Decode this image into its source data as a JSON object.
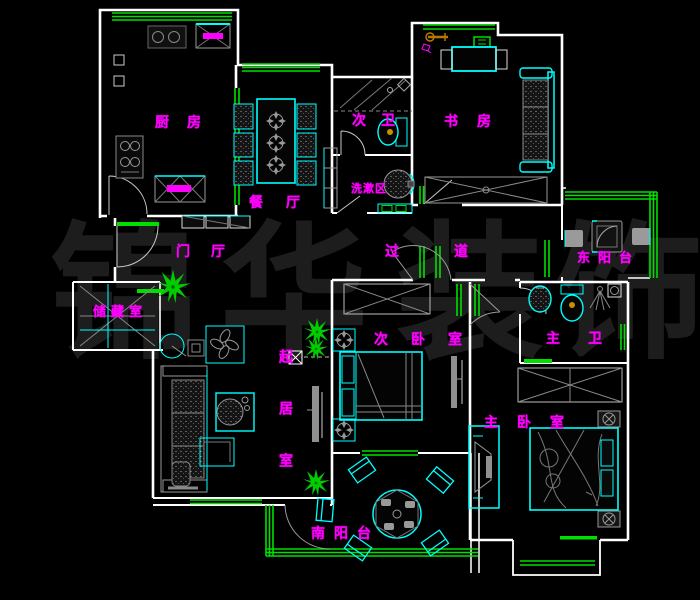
{
  "floor_plan": {
    "watermark": {
      "text": "锦华装饰",
      "chars": [
        "锦",
        "华",
        "装",
        "饰"
      ]
    },
    "rooms": {
      "kitchen": {
        "label": "厨房"
      },
      "dining": {
        "label": "餐厅"
      },
      "second_bath": {
        "label": "次卫"
      },
      "study": {
        "label": "书房"
      },
      "wash_area": {
        "label": "洗漱区"
      },
      "foyer": {
        "label": "门厅"
      },
      "corridor": {
        "label": "过道"
      },
      "east_balcony": {
        "label": "东阳台"
      },
      "storage": {
        "label": "储藏室"
      },
      "second_bedroom": {
        "label": "次卧室"
      },
      "master_bath": {
        "label": "主卫"
      },
      "living_room": {
        "label": "起居室"
      },
      "master_bedroom": {
        "label": "主卧室"
      },
      "south_balcony": {
        "label": "南阳台"
      }
    },
    "colors": {
      "background": "#000000",
      "walls": "#FFFFFF",
      "windows": "#00DF00",
      "fixtures": "#00FFFF",
      "furniture_lines": "#8F8F8F",
      "room_labels": "#FF00FF",
      "watermark_text": "#1D1D1D",
      "plants": "#00CC00",
      "cabinet_handles": "#FF00FF",
      "toilet_accent": "#C89000"
    }
  }
}
